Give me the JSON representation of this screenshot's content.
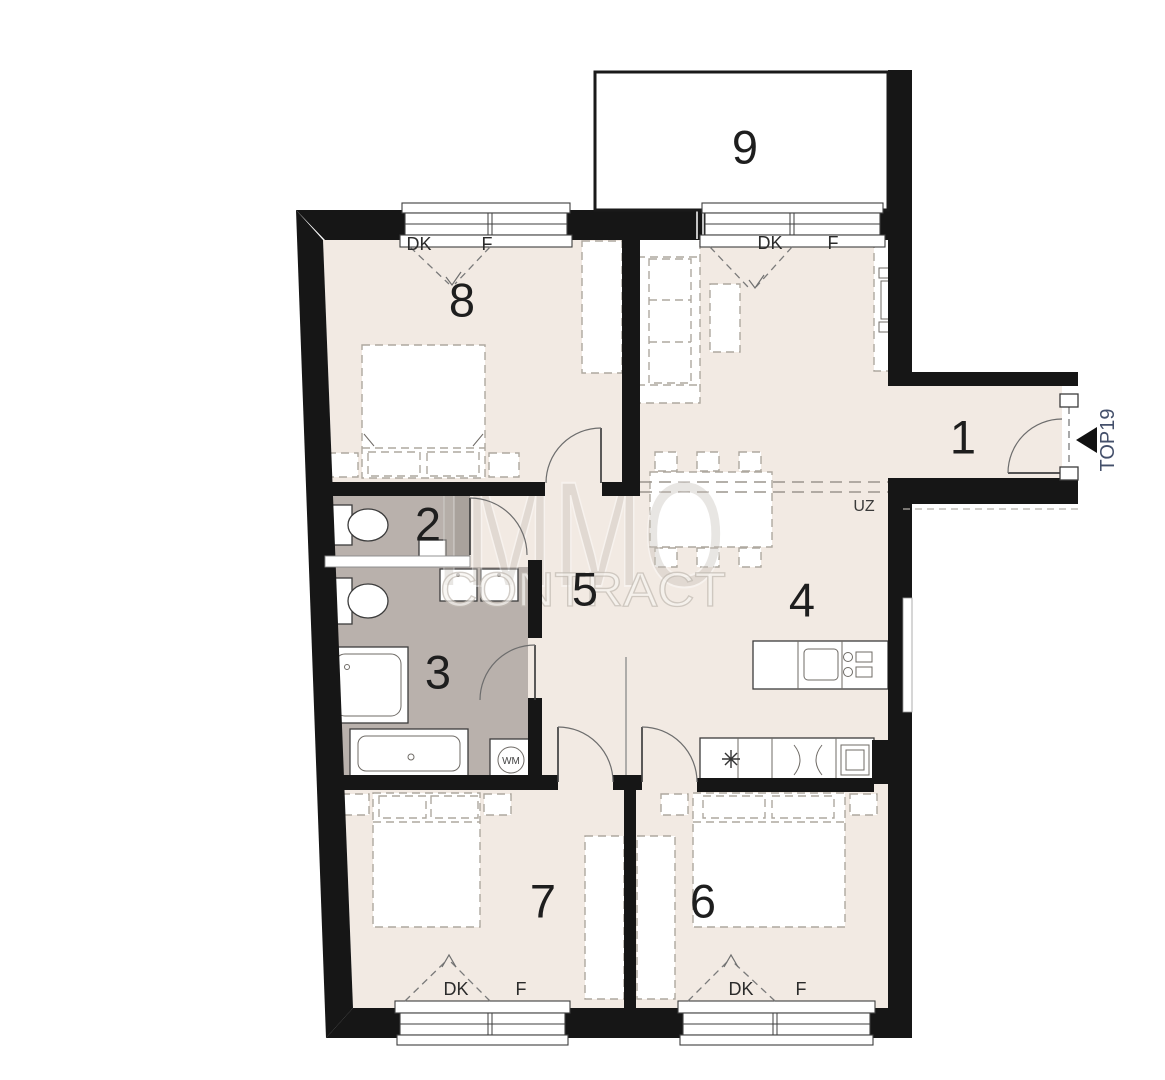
{
  "plan": {
    "title": "apartment floor plan",
    "unit_label": "TOP19",
    "beam_label": "UZ",
    "window_labels": {
      "dk": "DK",
      "f": "F"
    },
    "appliance_labels": {
      "washing_machine": "WM"
    },
    "watermark": {
      "line1": "IMMO",
      "line2": "CONTRACT"
    },
    "rooms": [
      {
        "number": "1"
      },
      {
        "number": "2"
      },
      {
        "number": "3"
      },
      {
        "number": "4"
      },
      {
        "number": "5"
      },
      {
        "number": "6"
      },
      {
        "number": "7"
      },
      {
        "number": "8"
      },
      {
        "number": "9"
      }
    ],
    "colors": {
      "floor": "#f2eae3",
      "wet_room_floor": "#b9b1ac",
      "wall": "#161616",
      "duct": "#a9a29c",
      "room1_accent": "#44506b"
    }
  }
}
